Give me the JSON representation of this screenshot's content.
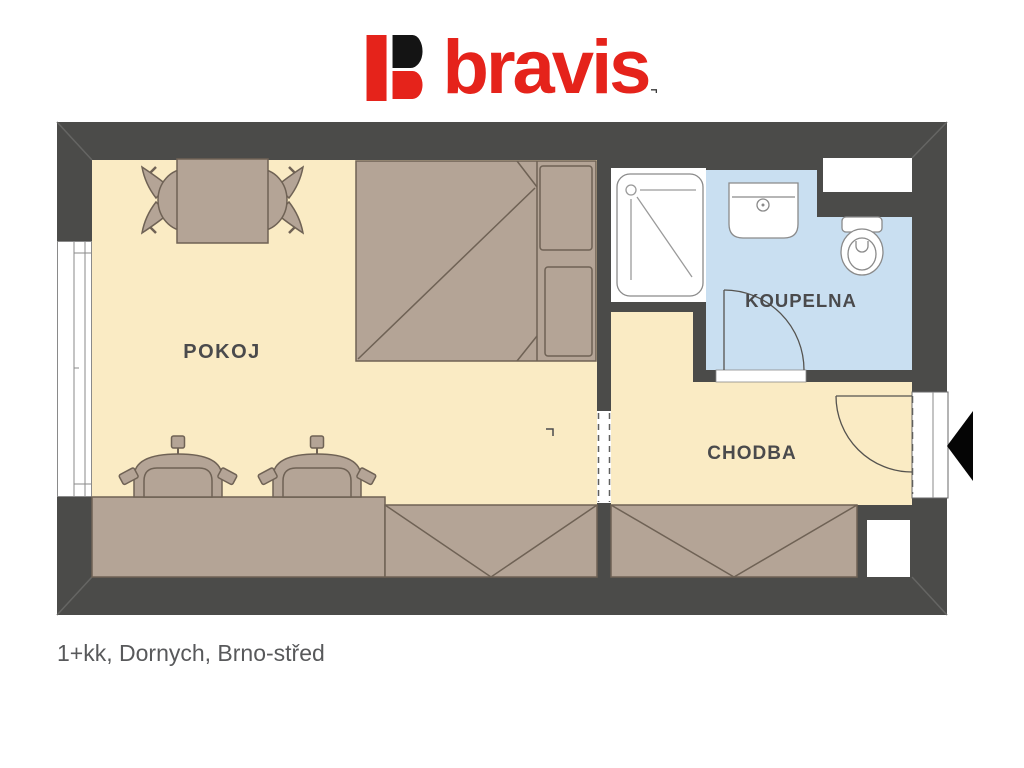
{
  "logo": {
    "brand": "bravis",
    "registered_mark": "¬",
    "colors": {
      "red": "#e5231b",
      "black": "#141414"
    }
  },
  "plan": {
    "room_labels": {
      "pokoj": "POKOJ",
      "koupelna": "KOUPELNA",
      "chodba": "CHODBA"
    },
    "colors": {
      "wall": "#4b4b49",
      "floor": "#faebc4",
      "bathroom_floor": "#c9dff1",
      "furniture": "#b4a496",
      "furniture_outline": "#6f6255",
      "fixture_outline": "#8a8a8a",
      "door_line": "#55534f",
      "entry_arrow": "#050505"
    },
    "fixture_icons": [
      "dining-table",
      "dining-chair",
      "double-bed",
      "armchair",
      "kitchen-counter",
      "built-in-wardrobe",
      "shower",
      "sink",
      "toilet",
      "window",
      "entrance-door",
      "interior-door-opening",
      "entry-arrow"
    ]
  },
  "caption": "1+kk, Dornych, Brno-střed"
}
